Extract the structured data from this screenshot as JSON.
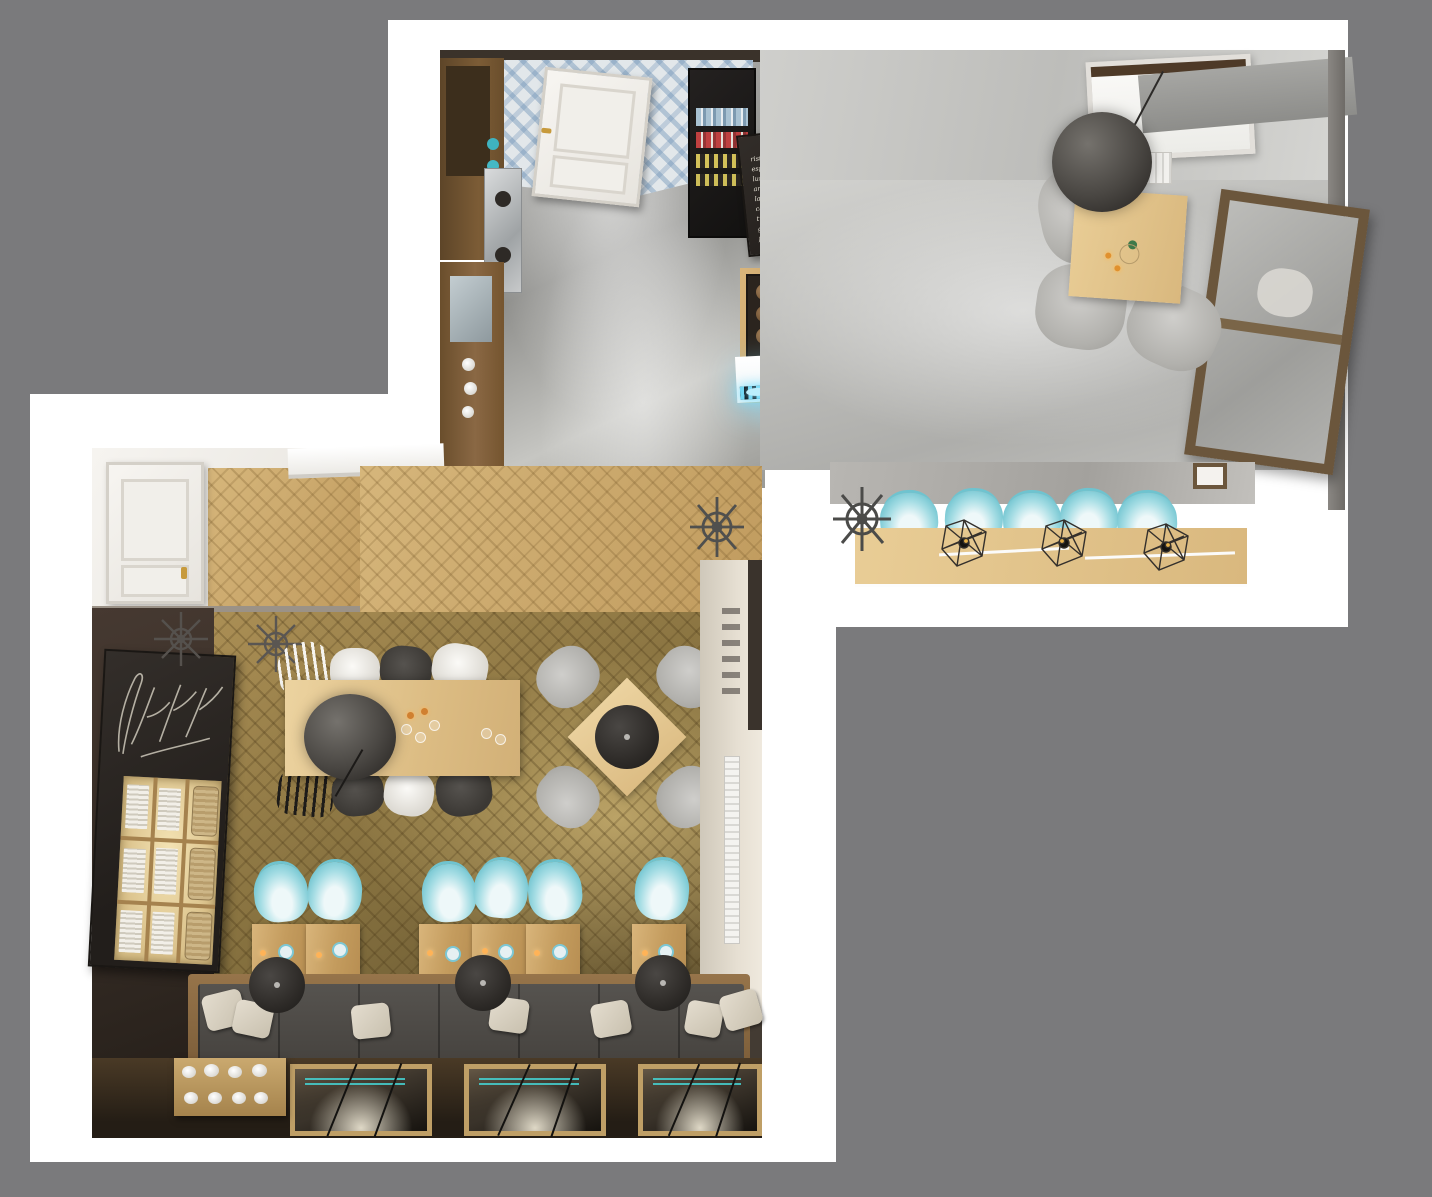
{
  "scene": {
    "background_color": "#7a7a7c",
    "sheet_color": "#ffffff",
    "accent_turquoise": "#6fc3cf",
    "led_glow_color": "#7de1ff",
    "wood_color": "#c49c5e",
    "parquet_color": "#86713f",
    "chalkboard_color": "#2b2724",
    "concrete_color": "#b5b5b2"
  },
  "upper_room": {
    "menu_board": {
      "title": "NABÍDKA:",
      "items": [
        "ristretto......30,-",
        "espresso......30,-",
        "lungo.........35,-",
        "americano.....40,-",
        "latte.........45,-",
        "cappuccino....45,-",
        "turek.........50,-",
        "glacé.........55,-",
        "flat white....50,-"
      ]
    }
  },
  "annotation_box": {
    "color": "#151515"
  }
}
